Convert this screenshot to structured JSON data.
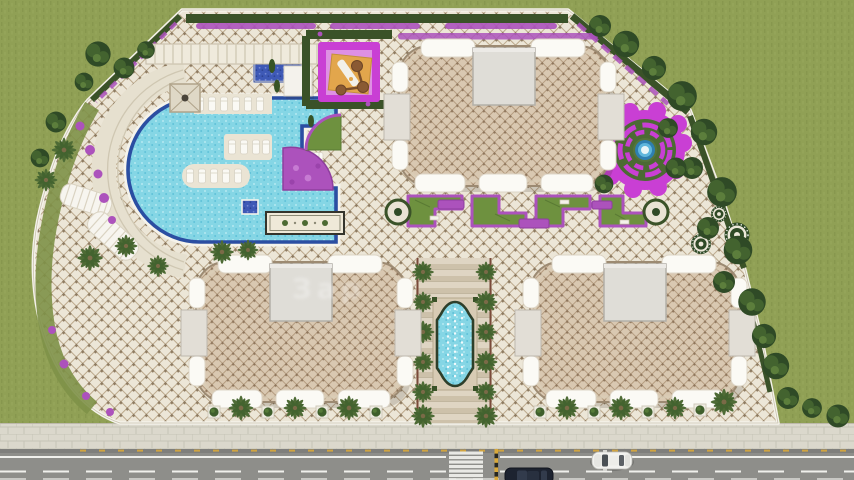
{
  "meta": {
    "type": "architectural-site-plan",
    "view": "top-down-render",
    "description": "Master plan of a residential complex with three apartment buildings, pool zone, playground, maze garden, fountain promenade and street"
  },
  "watermark": {
    "text": "Зар"
  },
  "site": {
    "buildings": [
      {
        "id": "north",
        "shape": "rounded-rectangle"
      },
      {
        "id": "southwest",
        "shape": "rounded-rectangle"
      },
      {
        "id": "southeast",
        "shape": "rounded-rectangle"
      }
    ],
    "amenities": [
      "free-form swimming pool",
      "children's pool",
      "jacuzzi",
      "sun loungers",
      "stepped terrace",
      "curved pergolas",
      "gazebo",
      "cabana row",
      "children's playground",
      "ornamental carpet walk",
      "flower fan bed",
      "parterre gardens with arbors",
      "circular maze garden with fountain",
      "central cartouche fountain",
      "palm promenade",
      "decorative round fountains",
      "perimeter hedge and flower border",
      "boundary wall"
    ],
    "street_features": [
      "paved sidewalk",
      "asphalt road",
      "zebra crosswalk",
      "lane markings",
      "yellow-black curb line",
      "white car",
      "dark car"
    ]
  },
  "colors": {
    "grass": "#90A055",
    "grass_dark": "#7F9048",
    "grass_light": "#9CAB61",
    "paving_base": "#ECE6D7",
    "paving_line": "#BCA98C",
    "paving_dot": "#8E7B61",
    "roof_base": "#D9C8B1",
    "roof_line": "#B0977A",
    "roof_dot": "#8F765C",
    "wall": "#F5F3EB",
    "hedge": "#3A5228",
    "lawn": "#6E913F",
    "flower": "#AC52BC",
    "magenta": "#C93FD4",
    "play_pink": "#DE90E3",
    "play_sand": "#E2A64C",
    "water_light": "#85D6E5",
    "pool_border": "#2B4EA2",
    "navy": "#3E59B6",
    "maze_green": "#4C6A33",
    "maze_blue": "#5FB6DC",
    "sidewalk": "#DBD8CC",
    "road": "#8E8E8A",
    "mark_white": "#F0F0EC",
    "mark_yellow": "#D9A93B",
    "bldg_white": "#FBFAF5",
    "bldg_gray": "#DFDDD7",
    "wing_gray": "#E2DED6",
    "tree_dark": "#2F4A26",
    "tree_mid": "#43632F",
    "tree_light": "#5C7E3C",
    "palm": "#4E6B35",
    "fountain_frame": "#D8CBB4",
    "fountain_border": "#2E3F2A",
    "terrace": "#E6E0CF",
    "carpet": "#EFE9D8"
  }
}
